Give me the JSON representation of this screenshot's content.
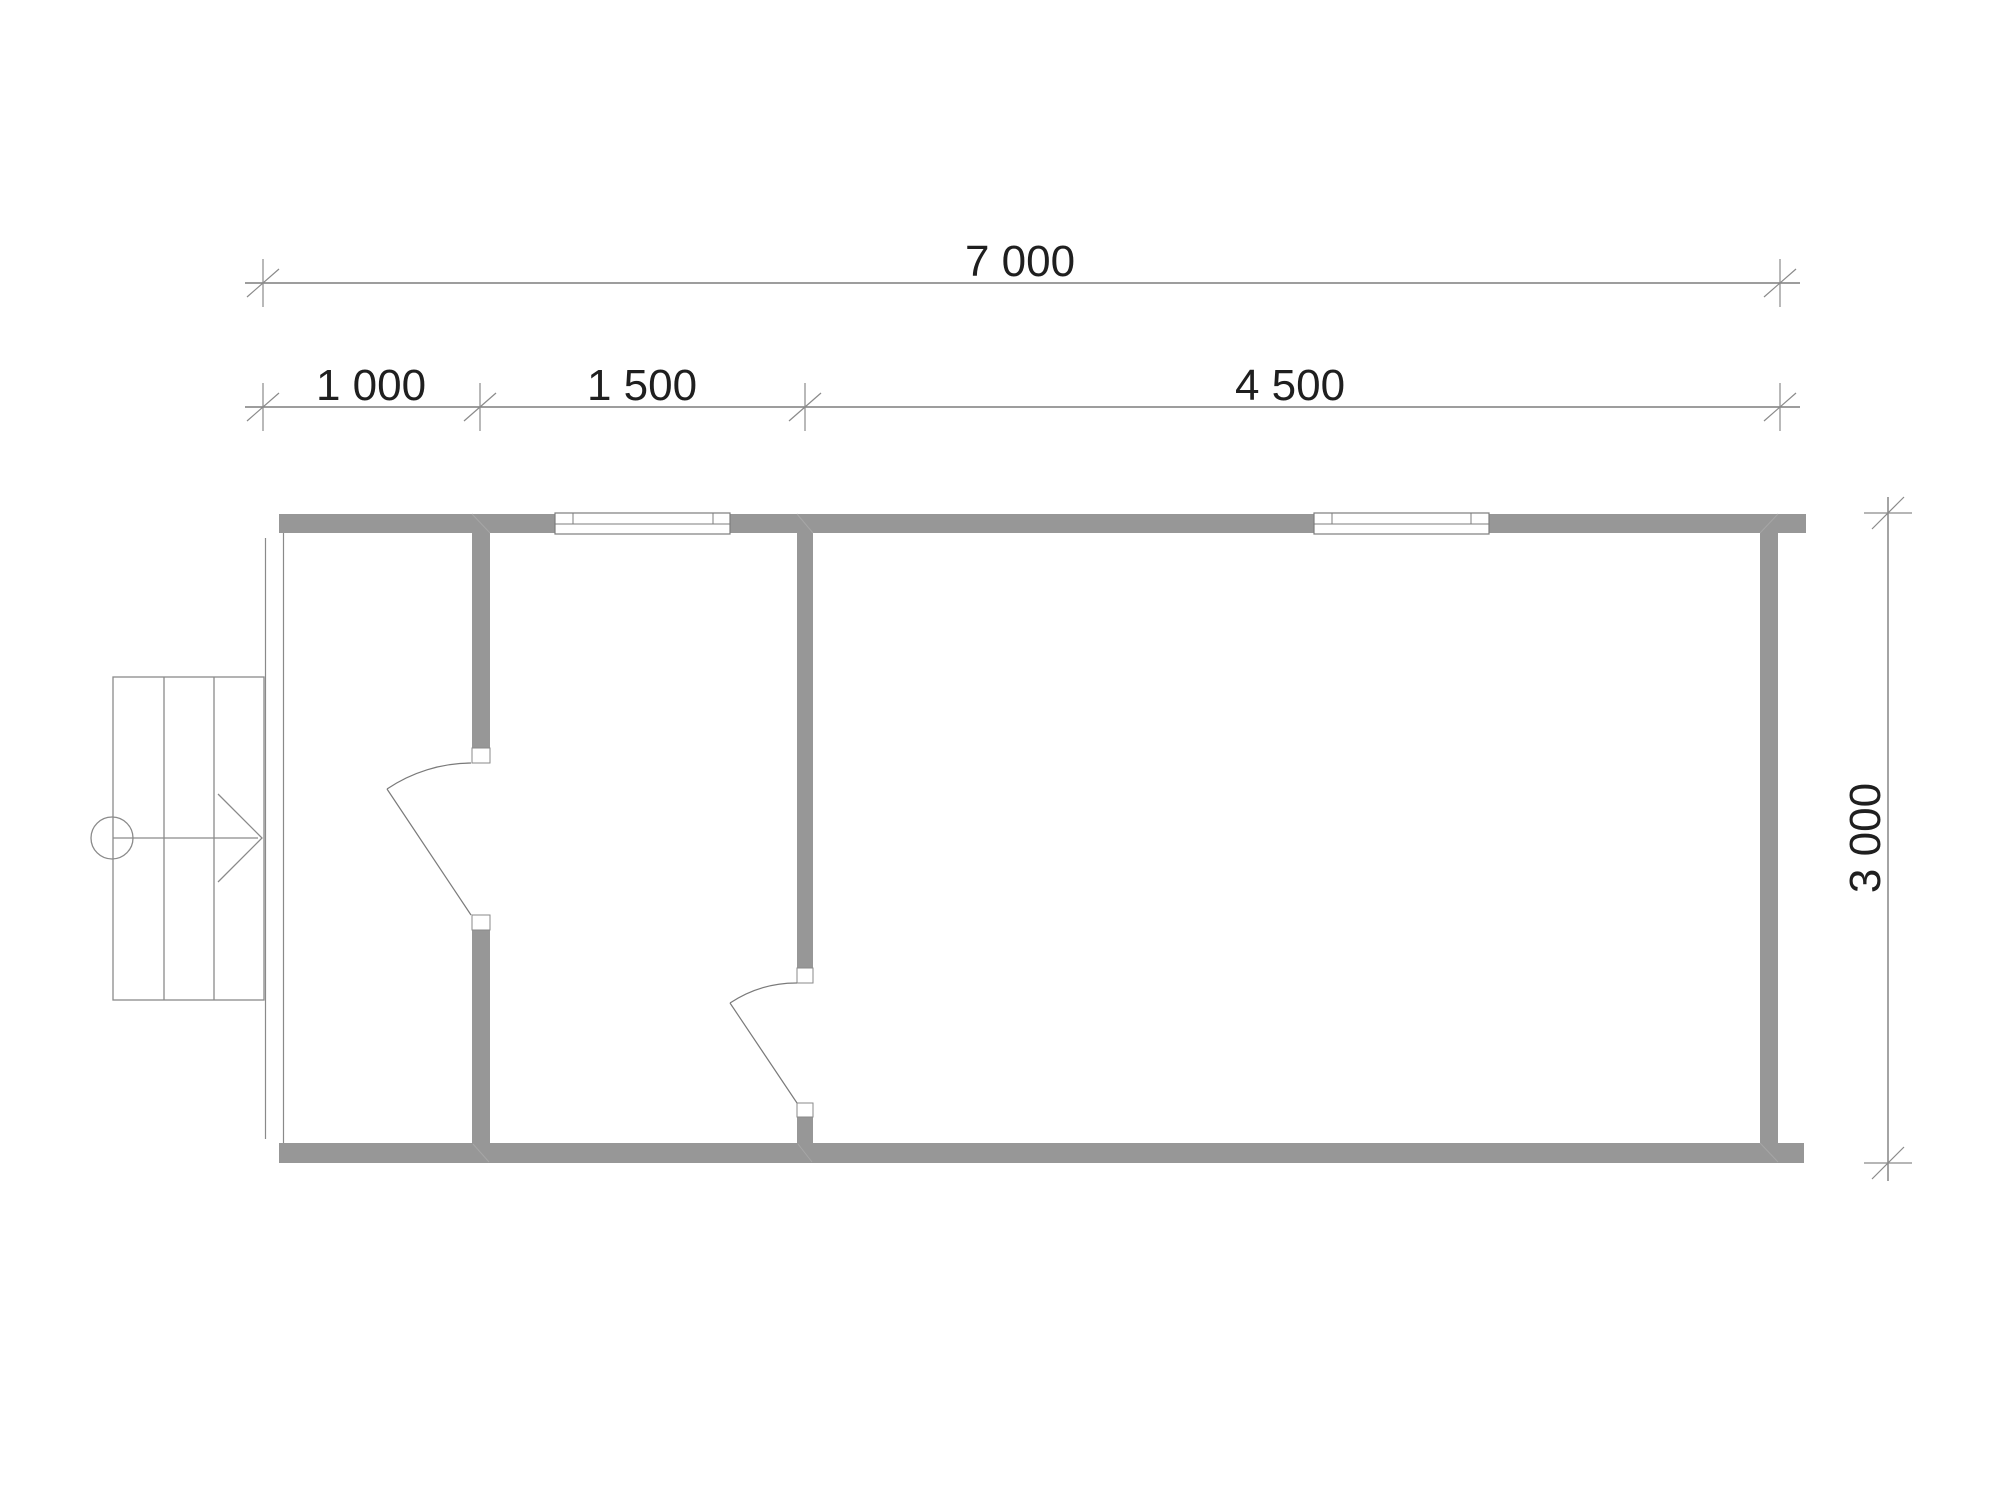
{
  "drawing": {
    "type": "architectural-floor-plan",
    "dimensions": {
      "total_width": {
        "label": "7 000",
        "value": 7000
      },
      "segments": [
        {
          "label": "1 000",
          "value": 1000
        },
        {
          "label": "1 500",
          "value": 1500
        },
        {
          "label": "4 500",
          "value": 4500
        }
      ],
      "height": {
        "label": "3 000",
        "value": 3000
      }
    },
    "colors": {
      "wall_fill": "#979797",
      "dimension_line": "#7d7d7d",
      "text": "#1f1f1f",
      "background": "#ffffff"
    }
  }
}
